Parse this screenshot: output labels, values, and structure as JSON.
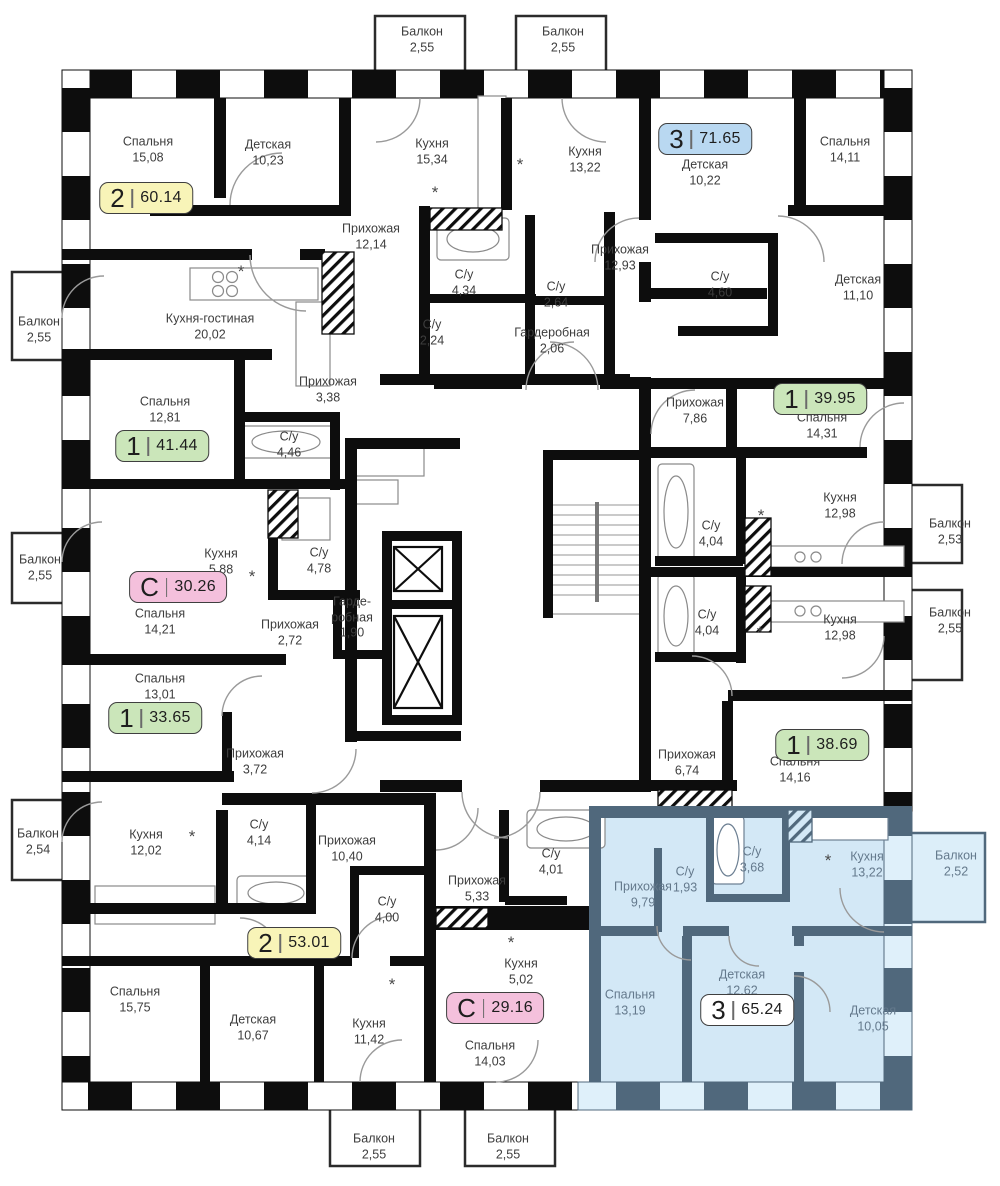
{
  "colors": {
    "badge_fills": {
      "yellow": "#f8f4b8",
      "blue": "#b9d8f1",
      "green": "#cbe6ba",
      "pink": "#f4c0dc",
      "white": "#ffffff"
    },
    "badge_border": "#3f3f3f",
    "wall": "#0d0d0d",
    "selected_fill": "#d3e8f6",
    "selected_wall": "#50687c",
    "label_text": "#3d3d3d",
    "selected_label_text": "#64798c"
  },
  "selected_apartment": {
    "type": "3",
    "area": "65.24"
  },
  "badges": [
    {
      "type": "2",
      "area": "60.14",
      "color": "yellow",
      "x": 146,
      "y": 198
    },
    {
      "type": "3",
      "area": "71.65",
      "color": "blue",
      "x": 705,
      "y": 139
    },
    {
      "type": "1",
      "area": "41.44",
      "color": "green",
      "x": 162,
      "y": 446
    },
    {
      "type": "1",
      "area": "39.95",
      "color": "green",
      "x": 820,
      "y": 399
    },
    {
      "type": "С",
      "area": "30.26",
      "color": "pink",
      "x": 178,
      "y": 587
    },
    {
      "type": "1",
      "area": "33.65",
      "color": "green",
      "x": 155,
      "y": 718
    },
    {
      "type": "1",
      "area": "38.69",
      "color": "green",
      "x": 822,
      "y": 745
    },
    {
      "type": "2",
      "area": "53.01",
      "color": "yellow",
      "x": 294,
      "y": 943
    },
    {
      "type": "С",
      "area": "29.16",
      "color": "pink",
      "x": 495,
      "y": 1008
    },
    {
      "type": "3",
      "area": "65.24",
      "color": "white",
      "x": 747,
      "y": 1010
    }
  ],
  "rooms": [
    {
      "name": "Балкон",
      "area": "2,55",
      "x": 422,
      "y": 40,
      "zone": "default"
    },
    {
      "name": "Балкон",
      "area": "2,55",
      "x": 563,
      "y": 40,
      "zone": "default"
    },
    {
      "name": "Спальня",
      "area": "15,08",
      "x": 148,
      "y": 150,
      "zone": "default"
    },
    {
      "name": "Детская",
      "area": "10,23",
      "x": 268,
      "y": 153,
      "zone": "default"
    },
    {
      "name": "Кухня",
      "area": "15,34",
      "x": 432,
      "y": 152,
      "zone": "default"
    },
    {
      "name": "Кухня",
      "area": "13,22",
      "x": 585,
      "y": 160,
      "zone": "default"
    },
    {
      "name": "Детская",
      "area": "10,22",
      "x": 705,
      "y": 173,
      "zone": "default"
    },
    {
      "name": "Спальня",
      "area": "14,11",
      "x": 845,
      "y": 150,
      "zone": "default"
    },
    {
      "name": "Прихожая",
      "area": "12,14",
      "x": 371,
      "y": 237,
      "zone": "default"
    },
    {
      "name": "С/у",
      "area": "4,34",
      "x": 464,
      "y": 283,
      "zone": "default"
    },
    {
      "name": "С/у",
      "area": "2,64",
      "x": 556,
      "y": 295,
      "zone": "default"
    },
    {
      "name": "Прихожая",
      "area": "12,93",
      "x": 620,
      "y": 258,
      "zone": "default"
    },
    {
      "name": "С/у",
      "area": "4,60",
      "x": 720,
      "y": 285,
      "zone": "default"
    },
    {
      "name": "Детская",
      "area": "11,10",
      "x": 858,
      "y": 288,
      "zone": "default"
    },
    {
      "name": "Балкон",
      "area": "2,55",
      "x": 39,
      "y": 330,
      "zone": "default"
    },
    {
      "name": "Кухня-гостиная",
      "area": "20,02",
      "x": 210,
      "y": 327,
      "zone": "default"
    },
    {
      "name": "С/у",
      "area": "2,24",
      "x": 432,
      "y": 333,
      "zone": "default"
    },
    {
      "name": "Гардеробная",
      "area": "2,06",
      "x": 552,
      "y": 341,
      "zone": "default"
    },
    {
      "name": "Прихожая",
      "area": "3,38",
      "x": 328,
      "y": 390,
      "zone": "default"
    },
    {
      "name": "Спальня",
      "area": "12,81",
      "x": 165,
      "y": 410,
      "zone": "default"
    },
    {
      "name": "С/у",
      "area": "4,46",
      "x": 289,
      "y": 445,
      "zone": "default"
    },
    {
      "name": "Прихожая",
      "area": "7,86",
      "x": 695,
      "y": 411,
      "zone": "default"
    },
    {
      "name": "Спальня",
      "area": "14,31",
      "x": 822,
      "y": 426,
      "zone": "default"
    },
    {
      "name": "Кухня",
      "area": "12,98",
      "x": 840,
      "y": 506,
      "zone": "default"
    },
    {
      "name": "Балкон",
      "area": "2,53",
      "x": 950,
      "y": 532,
      "zone": "default"
    },
    {
      "name": "С/у",
      "area": "4,04",
      "x": 711,
      "y": 534,
      "zone": "default"
    },
    {
      "name": "Кухня",
      "area": "5,88",
      "x": 221,
      "y": 562,
      "zone": "default"
    },
    {
      "name": "Балкон",
      "area": "2,55",
      "x": 40,
      "y": 568,
      "zone": "default"
    },
    {
      "name": "С/у",
      "area": "4,78",
      "x": 319,
      "y": 561,
      "zone": "default"
    },
    {
      "name": "Спальня",
      "area": "14,21",
      "x": 160,
      "y": 622,
      "zone": "default"
    },
    {
      "name": "Прихожая",
      "area": "2,72",
      "x": 290,
      "y": 633,
      "zone": "default"
    },
    {
      "name": "Гарде-\nробная",
      "area": "1,90",
      "x": 352,
      "y": 618,
      "zone": "default"
    },
    {
      "name": "С/у",
      "area": "4,04",
      "x": 707,
      "y": 623,
      "zone": "default"
    },
    {
      "name": "Кухня",
      "area": "12,98",
      "x": 840,
      "y": 628,
      "zone": "default"
    },
    {
      "name": "Балкон",
      "area": "2,55",
      "x": 950,
      "y": 621,
      "zone": "default"
    },
    {
      "name": "Спальня",
      "area": "13,01",
      "x": 160,
      "y": 687,
      "zone": "default"
    },
    {
      "name": "Прихожая",
      "area": "3,72",
      "x": 255,
      "y": 762,
      "zone": "default"
    },
    {
      "name": "Прихожая",
      "area": "6,74",
      "x": 687,
      "y": 763,
      "zone": "default"
    },
    {
      "name": "Спальня",
      "area": "14,16",
      "x": 795,
      "y": 770,
      "zone": "default"
    },
    {
      "name": "Балкон",
      "area": "2,54",
      "x": 38,
      "y": 842,
      "zone": "default"
    },
    {
      "name": "Кухня",
      "area": "12,02",
      "x": 146,
      "y": 843,
      "zone": "default"
    },
    {
      "name": "С/у",
      "area": "4,14",
      "x": 259,
      "y": 833,
      "zone": "default"
    },
    {
      "name": "Прихожая",
      "area": "10,40",
      "x": 347,
      "y": 849,
      "zone": "default"
    },
    {
      "name": "С/у",
      "area": "4,01",
      "x": 551,
      "y": 862,
      "zone": "default"
    },
    {
      "name": "Прихожая",
      "area": "5,33",
      "x": 477,
      "y": 889,
      "zone": "default"
    },
    {
      "name": "С/у",
      "area": "4,00",
      "x": 387,
      "y": 910,
      "zone": "default"
    },
    {
      "name": "Кухня",
      "area": "5,02",
      "x": 521,
      "y": 972,
      "zone": "default"
    },
    {
      "name": "Спальня",
      "area": "15,75",
      "x": 135,
      "y": 1000,
      "zone": "default"
    },
    {
      "name": "Детская",
      "area": "10,67",
      "x": 253,
      "y": 1028,
      "zone": "default"
    },
    {
      "name": "Кухня",
      "area": "11,42",
      "x": 369,
      "y": 1032,
      "zone": "default"
    },
    {
      "name": "Спальня",
      "area": "14,03",
      "x": 490,
      "y": 1054,
      "zone": "default"
    },
    {
      "name": "Прихожая",
      "area": "9,79",
      "x": 643,
      "y": 895,
      "zone": "blue"
    },
    {
      "name": "С/у",
      "area": "1,93",
      "x": 685,
      "y": 880,
      "zone": "blue"
    },
    {
      "name": "С/у",
      "area": "3,68",
      "x": 752,
      "y": 860,
      "zone": "blue"
    },
    {
      "name": "Кухня",
      "area": "13,22",
      "x": 867,
      "y": 865,
      "zone": "blue"
    },
    {
      "name": "Балкон",
      "area": "2,52",
      "x": 956,
      "y": 864,
      "zone": "blue"
    },
    {
      "name": "Спальня",
      "area": "13,19",
      "x": 630,
      "y": 1003,
      "zone": "blue"
    },
    {
      "name": "Детская",
      "area": "12,62",
      "x": 742,
      "y": 983,
      "zone": "blue"
    },
    {
      "name": "Детская",
      "area": "10,05",
      "x": 873,
      "y": 1019,
      "zone": "blue"
    },
    {
      "name": "Балкон",
      "area": "2,55",
      "x": 374,
      "y": 1147,
      "zone": "default"
    },
    {
      "name": "Балкон",
      "area": "2,55",
      "x": 508,
      "y": 1147,
      "zone": "default"
    }
  ],
  "fixture_marks": {
    "symbol": "*",
    "positions": [
      [
        435,
        193
      ],
      [
        520,
        165
      ],
      [
        241,
        272
      ],
      [
        761,
        516
      ],
      [
        760,
        633
      ],
      [
        828,
        861
      ],
      [
        511,
        943
      ],
      [
        192,
        837
      ],
      [
        252,
        577
      ],
      [
        392,
        985
      ]
    ]
  }
}
